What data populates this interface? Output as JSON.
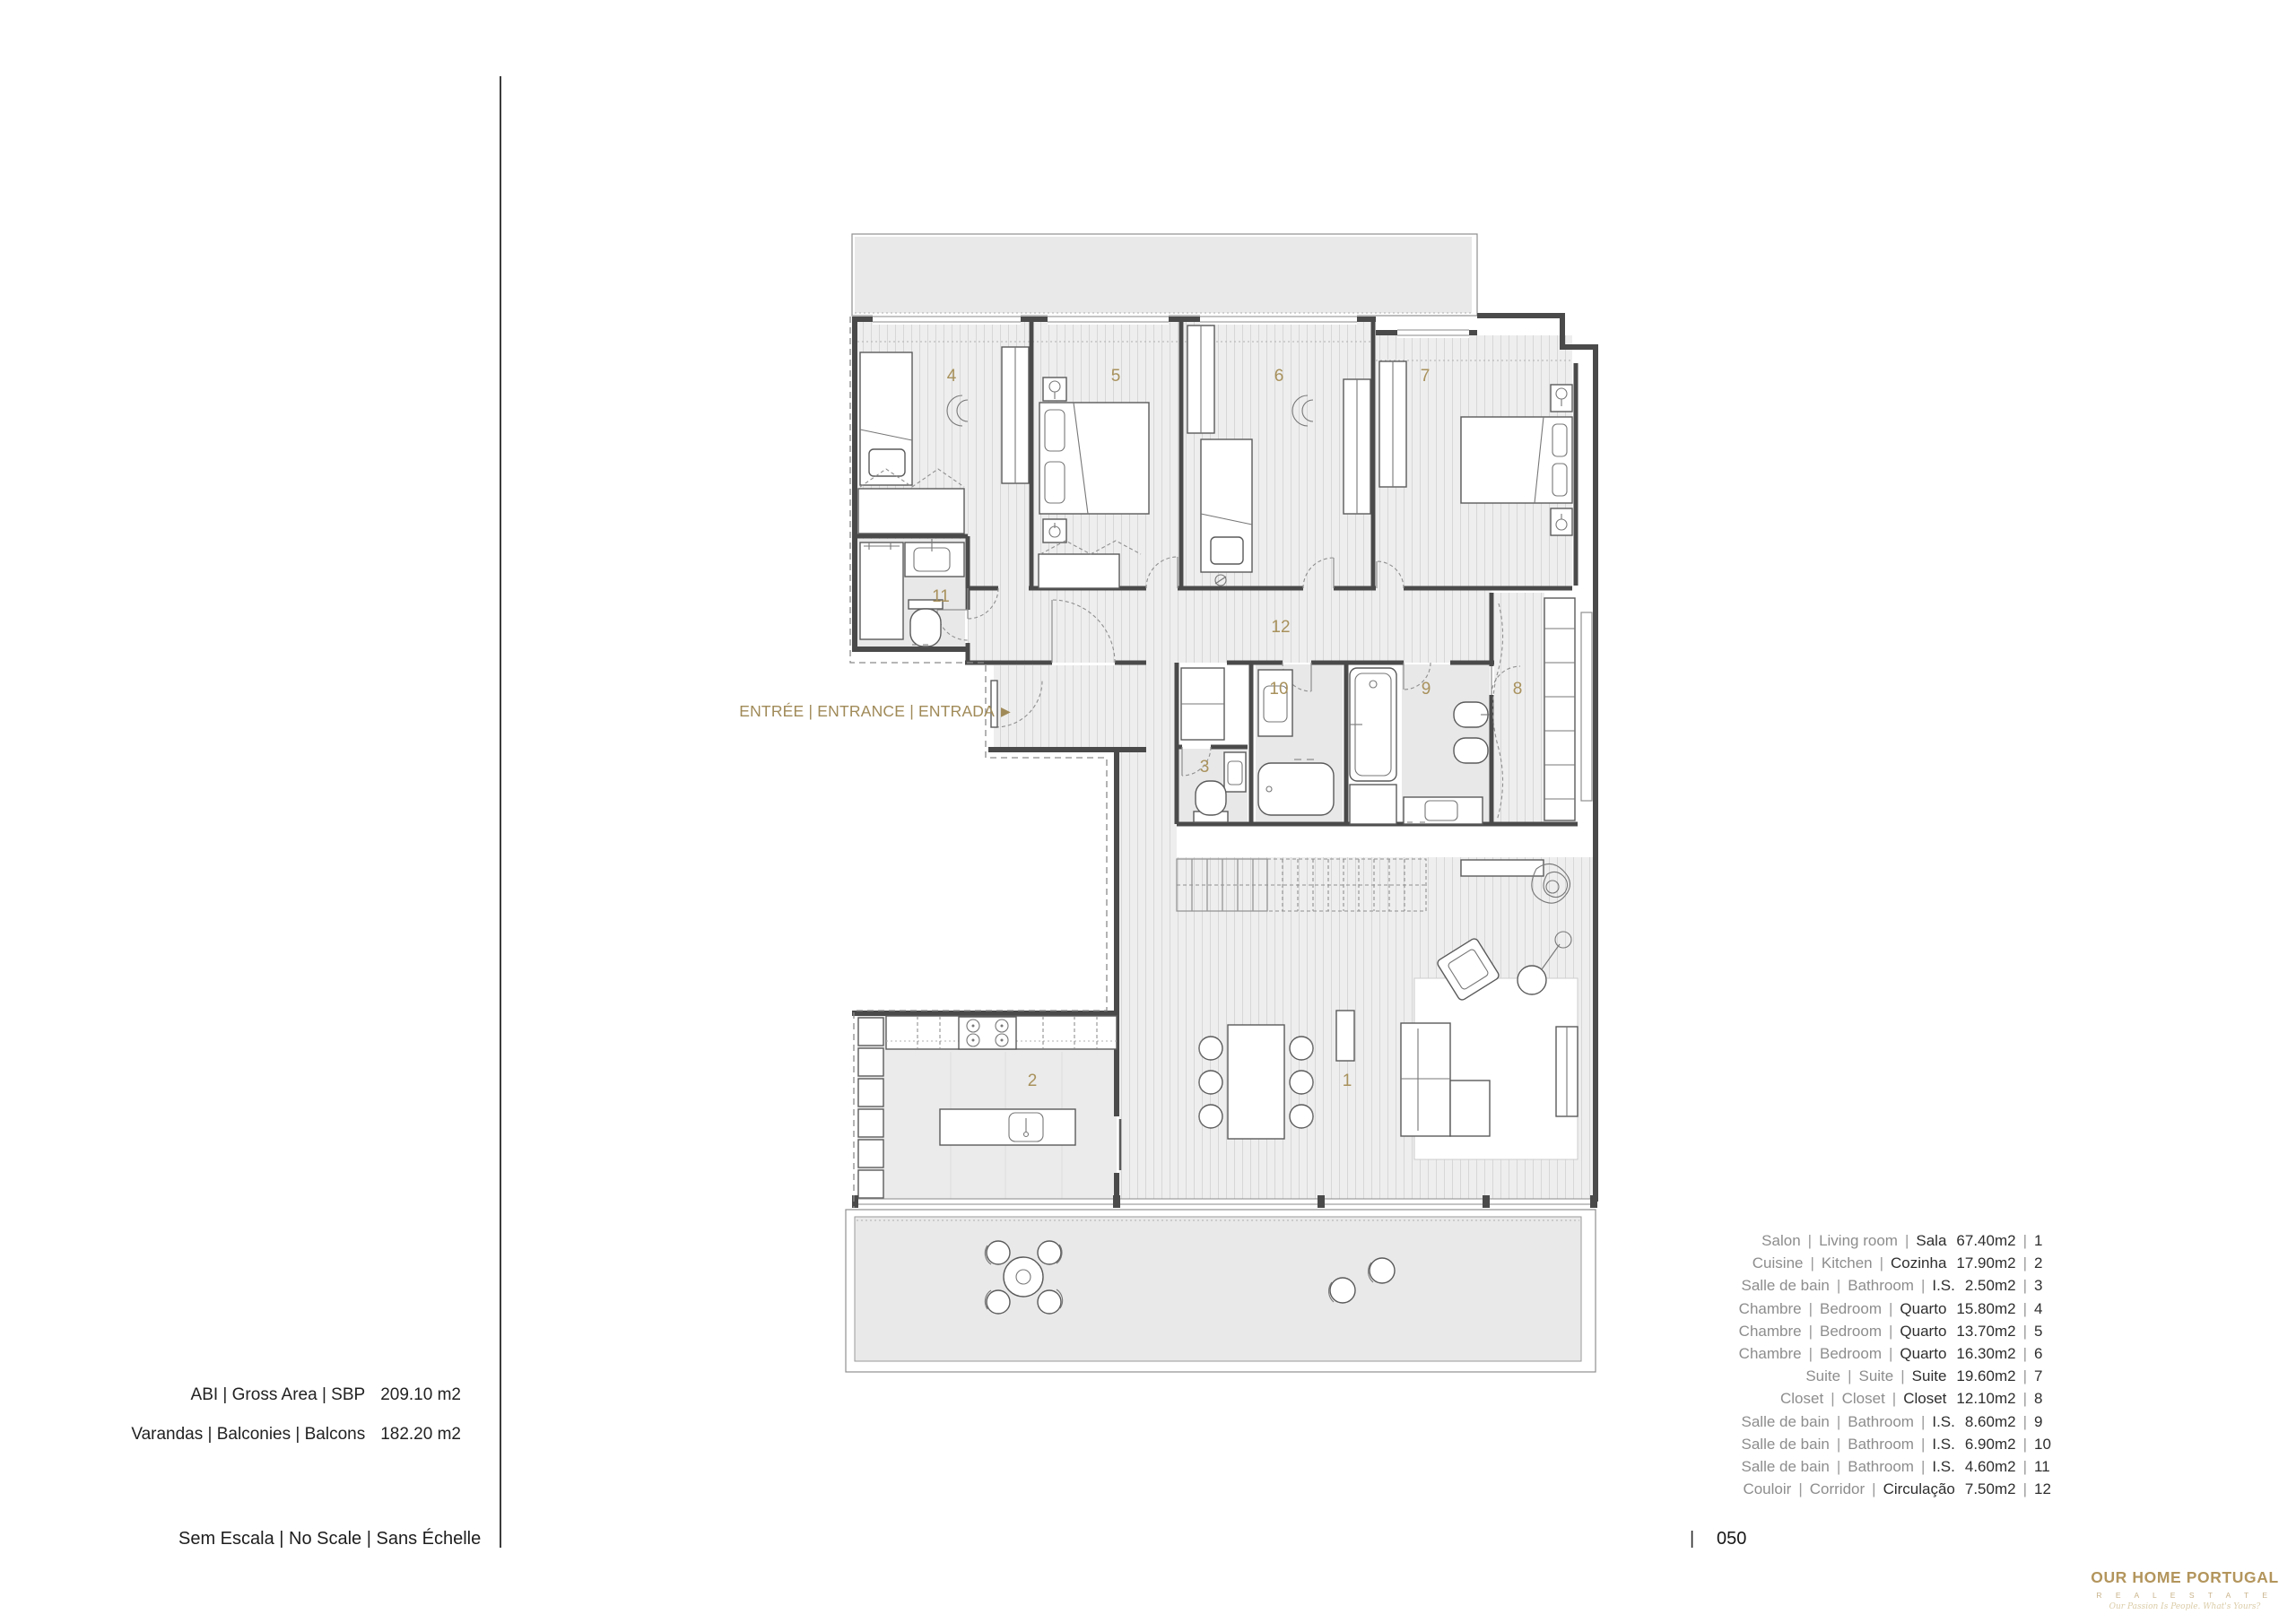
{
  "colors": {
    "accent_gold": "#a8915c",
    "wall": "#4a4a4a",
    "floor_fill": "#eeeeee",
    "terrace_fill": "#e9e9e9"
  },
  "plan": {
    "entrance_label": "ENTRÉE | ENTRANCE | ENTRADA",
    "entrance_arrow": "▶",
    "rooms": [
      {
        "num": "1"
      },
      {
        "num": "2"
      },
      {
        "num": "3"
      },
      {
        "num": "4"
      },
      {
        "num": "5"
      },
      {
        "num": "6"
      },
      {
        "num": "7"
      },
      {
        "num": "8"
      },
      {
        "num": "9"
      },
      {
        "num": "10"
      },
      {
        "num": "11"
      },
      {
        "num": "12"
      }
    ]
  },
  "legend": {
    "rows": [
      {
        "fr": "Salon",
        "en": "Living room",
        "pt": "Sala",
        "area": "67.40m2",
        "num": "1"
      },
      {
        "fr": "Cuisine",
        "en": "Kitchen",
        "pt": "Cozinha",
        "area": "17.90m2",
        "num": "2"
      },
      {
        "fr": "Salle de bain",
        "en": "Bathroom",
        "pt": "I.S.",
        "area": "2.50m2",
        "num": "3"
      },
      {
        "fr": "Chambre",
        "en": "Bedroom",
        "pt": "Quarto",
        "area": "15.80m2",
        "num": "4"
      },
      {
        "fr": "Chambre",
        "en": "Bedroom",
        "pt": "Quarto",
        "area": "13.70m2",
        "num": "5"
      },
      {
        "fr": "Chambre",
        "en": "Bedroom",
        "pt": "Quarto",
        "area": "16.30m2",
        "num": "6"
      },
      {
        "fr": "Suite",
        "en": "Suite",
        "pt": "Suite",
        "area": "19.60m2",
        "num": "7"
      },
      {
        "fr": "Closet",
        "en": "Closet",
        "pt": "Closet",
        "area": "12.10m2",
        "num": "8"
      },
      {
        "fr": "Salle de bain",
        "en": "Bathroom",
        "pt": "I.S.",
        "area": "8.60m2",
        "num": "9"
      },
      {
        "fr": "Salle de bain",
        "en": "Bathroom",
        "pt": "I.S.",
        "area": "6.90m2",
        "num": "10"
      },
      {
        "fr": "Salle de bain",
        "en": "Bathroom",
        "pt": "I.S.",
        "area": "4.60m2",
        "num": "11"
      },
      {
        "fr": "Couloir",
        "en": "Corridor",
        "pt": "Circulação",
        "area": "7.50m2",
        "num": "12"
      }
    ]
  },
  "areas": [
    {
      "label": "ABI | Gross Area | SBP",
      "value": "209.10 m2"
    },
    {
      "label": "Varandas | Balconies | Balcons",
      "value": "182.20 m2"
    }
  ],
  "scale_note": "Sem Escala | No Scale | Sans Échelle",
  "footer": {
    "sep": "|",
    "apartment_label": "APARTAMENTO",
    "apartment_number": "10A",
    "sheet_number": "050"
  },
  "logo": {
    "title": "OUR HOME PORTUGAL",
    "subtitle": "R E A L   E S T A T E",
    "tagline": "Our Passion Is People. What's Yours?"
  }
}
